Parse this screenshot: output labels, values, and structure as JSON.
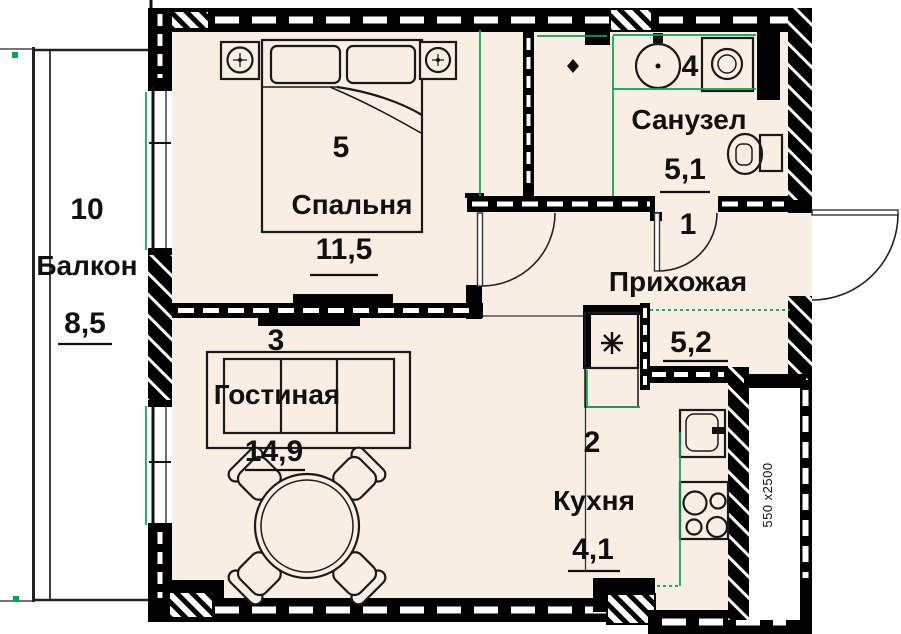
{
  "plan": {
    "rooms": {
      "balcony": {
        "number": "10",
        "name": "Балкон",
        "area": "8,5"
      },
      "bedroom": {
        "number": "5",
        "name": "Спальня",
        "area": "11,5"
      },
      "bathroom": {
        "number": "4",
        "name": "Санузел",
        "area": "5,1"
      },
      "hallway": {
        "number": "1",
        "name": "Прихожая",
        "area": "5,2"
      },
      "living_room": {
        "number": "3",
        "name": "Гостиная",
        "area": "14,9"
      },
      "kitchen": {
        "number": "2",
        "name": "Кухня",
        "area": "4,1"
      }
    },
    "shaft_label": "550 x2500",
    "colors": {
      "floor": "#f8eee4",
      "balcony_floor": "#ffffff",
      "wall": "#000000",
      "measure_green": "#00a651",
      "text": "#111111"
    }
  }
}
